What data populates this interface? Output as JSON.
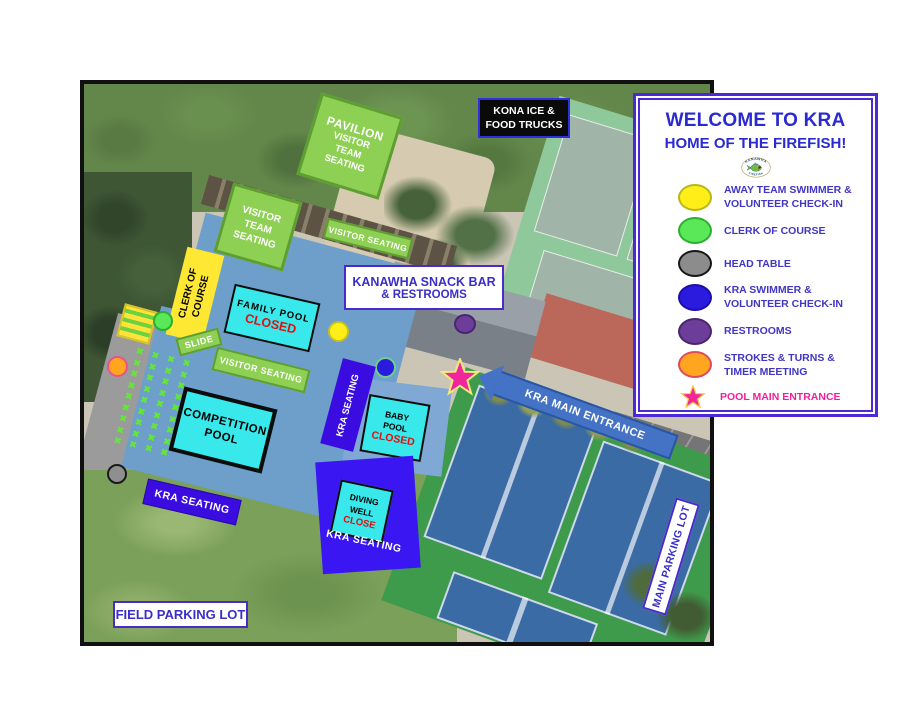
{
  "legend": {
    "title": "WELCOME TO KRA",
    "subtitle": "HOME OF THE FIREFISH!",
    "logo": {
      "arc_top": "KANAWHA",
      "arc_bottom": "FIREFISH"
    },
    "items": [
      {
        "icon": "yellow-dot",
        "line1": "AWAY TEAM SWIMMER &",
        "line2": "VOLUNTEER CHECK-IN"
      },
      {
        "icon": "green-dot",
        "line1": "CLERK OF COURSE",
        "line2": ""
      },
      {
        "icon": "gray-dot",
        "line1": "HEAD TABLE",
        "line2": ""
      },
      {
        "icon": "blue-dot",
        "line1": "KRA SWIMMER &",
        "line2": "VOLUNTEER CHECK-IN"
      },
      {
        "icon": "purple-dot",
        "line1": "RESTROOMS",
        "line2": ""
      },
      {
        "icon": "orange-dot",
        "line1": "STROKES & TURNS &",
        "line2": "TIMER MEETING"
      },
      {
        "icon": "pink-star",
        "line1": "POOL MAIN ENTRANCE",
        "line2": ""
      }
    ]
  },
  "map": {
    "labels": {
      "kona_ice": {
        "line1": "KONA ICE &",
        "line2": "FOOD TRUCKS"
      },
      "pavilion": {
        "line1": "PAVILION",
        "line2": "VISITOR",
        "line3": "TEAM",
        "line4": "SEATING"
      },
      "visitor_team_seating": {
        "line1": "VISITOR",
        "line2": "TEAM",
        "line3": "SEATING"
      },
      "visitor_seating_top": "VISITOR  SEATING",
      "visitor_seating_mid": "VISITOR SEATING",
      "clerk_of_course": {
        "line1": "CLERK OF",
        "line2": "COURSE"
      },
      "slide": "SLIDE",
      "family_pool": {
        "name": "FAMILY  POOL",
        "status": "CLOSED"
      },
      "snack_bar": {
        "line1": "KANAWHA SNACK BAR",
        "line2": "& RESTROOMS"
      },
      "competition_pool": {
        "line1": "COMPETITION",
        "line2": "POOL"
      },
      "baby_pool": {
        "line1": "BABY",
        "line2": "POOL",
        "status": "CLOSED"
      },
      "diving_well": {
        "line1": "DIVING",
        "line2": "WELL",
        "status": "CLOSE"
      },
      "kra_seating_left": "KRA SEATING",
      "kra_seating_center": "KRA SEATING",
      "kra_seating_diving": "KRA SEATING",
      "kra_main_entrance": "KRA MAIN ENTRANCE",
      "main_parking_lot": "MAIN PARKING LOT",
      "field_parking_lot": "FIELD PARKING LOT"
    },
    "markers": [
      {
        "name": "away-team-check-in-dot",
        "color": "#ffee18"
      },
      {
        "name": "clerk-of-course-dot",
        "color": "#58e858"
      },
      {
        "name": "head-table-dot",
        "color": "#8f8f8f"
      },
      {
        "name": "kra-check-in-dot",
        "color": "#2b1bdf"
      },
      {
        "name": "restrooms-dot",
        "color": "#6c3d99"
      },
      {
        "name": "strokes-turns-timer-dot",
        "color": "#ffa51f"
      },
      {
        "name": "pool-main-entrance-star",
        "color": "#f1259c"
      }
    ],
    "x_marks": {
      "rows": 9,
      "cols": 4,
      "glyph": "✖",
      "color": "#64e63a"
    }
  },
  "colors": {
    "legend_border": "#4b28d8",
    "legend_text": "#4136c4",
    "title_text": "#2a2ad0",
    "pink_text": "#f01f9e",
    "label_green": "#8ed054",
    "pool_cyan": "#38e8ea",
    "closed_red": "#e01010",
    "seating_indigo": "#3a0ce0",
    "entrance_blue": "#4473c5",
    "pool_deck_blue": "#6d9fca"
  }
}
